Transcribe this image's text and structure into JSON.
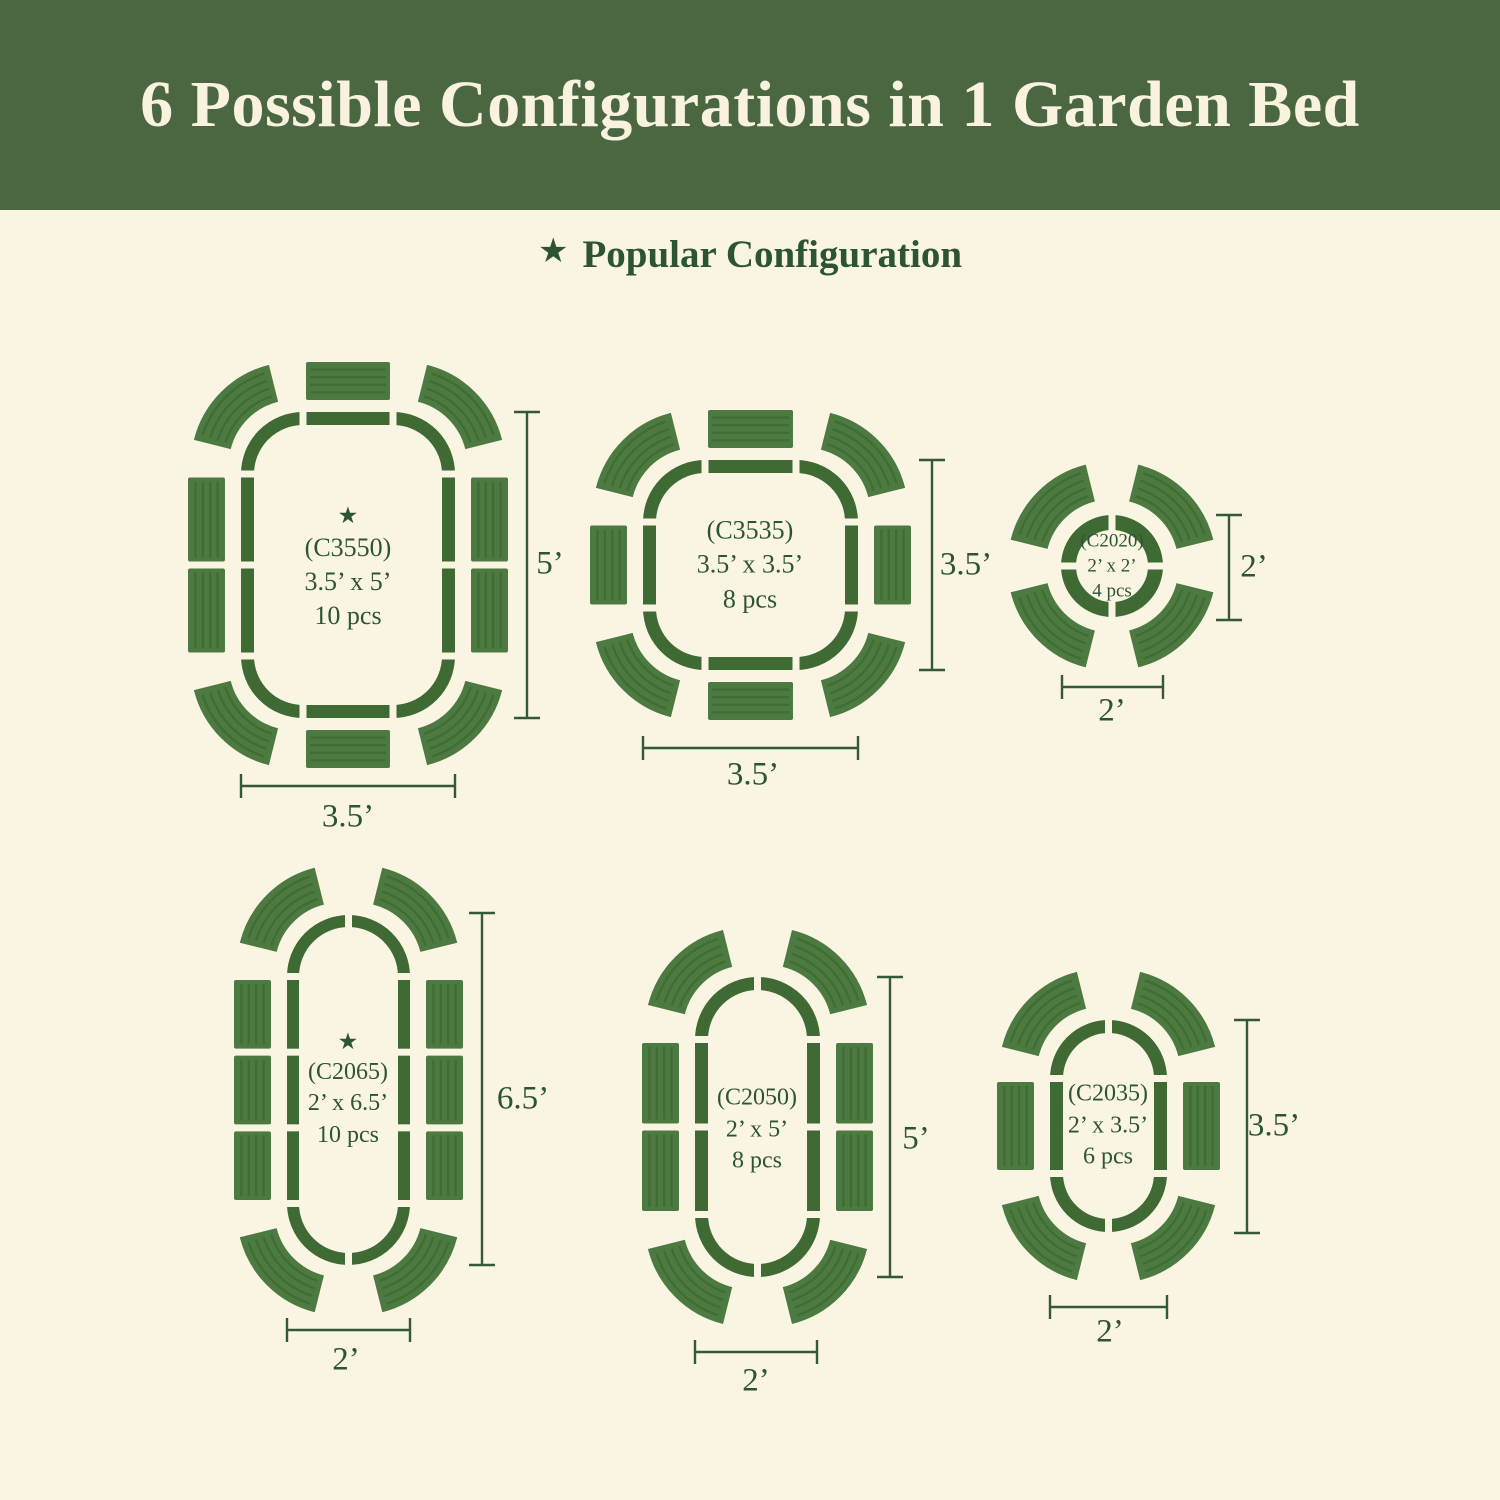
{
  "header": {
    "title": "6 Possible Configurations in 1 Garden Bed"
  },
  "legend": {
    "star": "★",
    "label": "Popular Configuration"
  },
  "colors": {
    "banner_green": "#4a6741",
    "background_cream": "#faf4e3",
    "title_cream": "#f8f2df",
    "bed_outline_green": "#3f6a33",
    "panel_green": "#4d7a41",
    "panel_rib_green": "#38622e",
    "text_green": "#2d5434",
    "dimension_line_green": "#33593a"
  },
  "configs": [
    {
      "code": "(C3550)",
      "size": "3.5’ x 5’",
      "pieces": "10 pcs",
      "popular": true,
      "height_label": "5’",
      "width_label": "3.5’"
    },
    {
      "code": "(C3535)",
      "size": "3.5’ x 3.5’",
      "pieces": "8 pcs",
      "popular": false,
      "height_label": "3.5’",
      "width_label": "3.5’"
    },
    {
      "code": "(C2020)",
      "size": "2’ x 2’",
      "pieces": "4 pcs",
      "popular": false,
      "height_label": "2’",
      "width_label": "2’"
    },
    {
      "code": "(C2065)",
      "size": "2’ x 6.5’",
      "pieces": "10 pcs",
      "popular": true,
      "height_label": "6.5’",
      "width_label": "2’"
    },
    {
      "code": "(C2050)",
      "size": "2’ x 5’",
      "pieces": "8 pcs",
      "popular": false,
      "height_label": "5’",
      "width_label": "2’"
    },
    {
      "code": "(C2035)",
      "size": "2’ x 3.5’",
      "pieces": "6 pcs",
      "popular": false,
      "height_label": "3.5’",
      "width_label": "2’"
    }
  ]
}
